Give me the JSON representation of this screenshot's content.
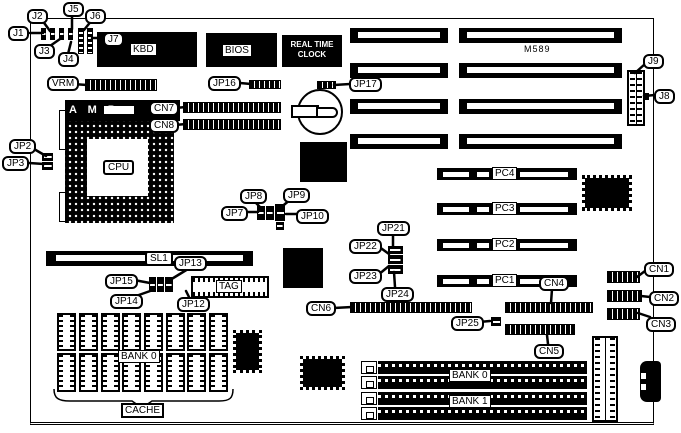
{
  "model": "M589",
  "blocks": {
    "kbd": "KBD",
    "bios": "BIOS",
    "rtc_line1": "REAL TIME",
    "rtc_line2": "CLOCK",
    "amp": "A M P"
  },
  "callouts": {
    "j1": "J1",
    "j2": "J2",
    "j3": "J3",
    "j4": "J4",
    "j5": "J5",
    "j6": "J6",
    "j7": "J7",
    "j8": "J8",
    "j9": "J9",
    "vrm": "VRM",
    "jp2": "JP2",
    "jp3": "JP3",
    "cn7": "CN7",
    "cn8": "CN8",
    "jp16": "JP16",
    "jp17": "JP17",
    "cpu": "CPU",
    "jp7": "JP7",
    "jp8": "JP8",
    "jp9": "JP9",
    "jp10": "JP10",
    "jp21": "JP21",
    "jp22": "JP22",
    "jp23": "JP23",
    "jp24": "JP24",
    "jp25": "JP25",
    "sl1": "SL1",
    "jp12": "JP12",
    "jp13": "JP13",
    "jp14": "JP14",
    "jp15": "JP15",
    "tag": "TAG",
    "cn1": "CN1",
    "cn2": "CN2",
    "cn3": "CN3",
    "cn4": "CN4",
    "cn5": "CN5",
    "cn6": "CN6"
  },
  "slots": {
    "pc1": "PC1",
    "pc2": "PC2",
    "pc3": "PC3",
    "pc4": "PC4"
  },
  "memory": {
    "cache_bank": "BANK 0",
    "cache": "CACHE",
    "simm_bank0": "BANK 0",
    "simm_bank1": "BANK 1"
  }
}
